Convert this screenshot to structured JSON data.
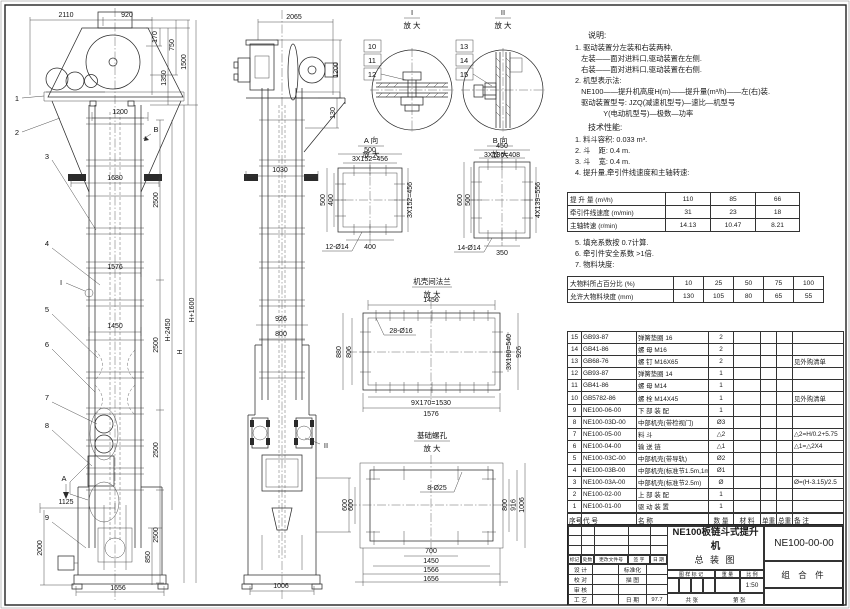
{
  "sheet": {
    "product": "NE100板链斗式提升机",
    "sheet_name": "总  装  图",
    "drawing_no": "NE100-00-00",
    "part_type": "组 合 件",
    "scale": "1:50",
    "date": "97.7"
  },
  "notes": {
    "title": "说明:",
    "lines": [
      "1. 驱动装置分左装和右装两种,",
      "   左装——面对进料口,驱动装置在左侧.",
      "   右装——面对进料口,驱动装置在右侧.",
      "2. 机型表示法:",
      "   NE100——提升机高度H(m)——提升量(m³/h)——左(右)装.",
      "   驱动装置型号: JZQ(减速机型号)—速比—机型号",
      "              Y(电动机型号)—极数—功率"
    ]
  },
  "tech": {
    "title": "技术性能:",
    "lines": [
      "1. 料斗容积: 0.033 m³.",
      "2. 斗    距: 0.4 m.",
      "3. 斗    宽: 0.4 m.",
      "4. 提升量,牵引件线速度和主轴转速:"
    ],
    "lines2": [
      "5. 填充系数按 0.7计算.",
      "6. 牵引件安全系数 >1倍.",
      "7. 物料块度:"
    ]
  },
  "spec_table": {
    "rows": [
      [
        "提 升 量  (m³/h)",
        "110",
        "85",
        "66"
      ],
      [
        "牵引件线速度 (m/min)",
        "31",
        "23",
        "18"
      ],
      [
        "主轴转速 (r/min)",
        "14.13",
        "10.47",
        "8.21"
      ]
    ]
  },
  "lump_table": {
    "rows": [
      [
        "大物料所占百分比 (%)",
        "10",
        "25",
        "50",
        "75",
        "100"
      ],
      [
        "允许大物料块度 (mm)",
        "130",
        "105",
        "80",
        "65",
        "55"
      ]
    ]
  },
  "bom": {
    "header_rows": [
      [
        "序号",
        "代  号",
        "名    称",
        "数 量",
        "材  料",
        "单重",
        "总重",
        "备  注"
      ]
    ],
    "rows": [
      [
        "15",
        "GB93-87",
        "弹簧垫圈 16",
        "2",
        "",
        "",
        "",
        ""
      ],
      [
        "14",
        "GB41-86",
        "螺  母  M16",
        "2",
        "",
        "",
        "",
        ""
      ],
      [
        "13",
        "GB68-76",
        "螺  钉  M16X65",
        "2",
        "",
        "",
        "",
        "见外购清单"
      ],
      [
        "12",
        "GB93-87",
        "弹簧垫圈 14",
        "1",
        "",
        "",
        "",
        ""
      ],
      [
        "11",
        "GB41-86",
        "螺  母  M14",
        "1",
        "",
        "",
        "",
        ""
      ],
      [
        "10",
        "GB5782-86",
        "螺  栓  M14X45",
        "1",
        "",
        "",
        "",
        "见外购清单"
      ],
      [
        "9",
        "NE100-06-00",
        "下 部 装 配",
        "1",
        "",
        "",
        "",
        ""
      ],
      [
        "8",
        "NE100-03D-00",
        "中部机壳(带检视门)",
        "Ø3",
        "",
        "",
        "",
        ""
      ],
      [
        "7",
        "NE100-05-00",
        "料  斗",
        "△2",
        "",
        "",
        "",
        "△2=H/0.2+5.75"
      ],
      [
        "6",
        "NE100-04-00",
        "输 送 链",
        "△1",
        "",
        "",
        "",
        "△1=△2X4"
      ],
      [
        "5",
        "NE100-03C-00",
        "中部机壳(带导轨)",
        "Ø2",
        "",
        "",
        "",
        ""
      ],
      [
        "4",
        "NE100-03B-00",
        "中部机壳(标准节1.5m,1m)",
        "Ø1",
        "",
        "",
        "",
        ""
      ],
      [
        "3",
        "NE100-03A-00",
        "中部机壳(标准节2.5m)",
        "Ø",
        "",
        "",
        "",
        "Ø=(H-3.15)/2.5"
      ],
      [
        "2",
        "NE100-02-00",
        "上 部 装 配",
        "1",
        "",
        "",
        "",
        ""
      ],
      [
        "1",
        "NE100-01-00",
        "驱 动 装 置",
        "1",
        "",
        "",
        "",
        ""
      ]
    ]
  },
  "title_block": {
    "rev_empty": [
      [
        "",
        "",
        "",
        "",
        ""
      ],
      [
        "",
        "",
        "",
        "",
        ""
      ],
      [
        "",
        "",
        "",
        "",
        ""
      ]
    ],
    "rev_header": [
      "标记",
      "处数",
      "更改文件号",
      "签 字",
      "日 期"
    ],
    "left_rows": [
      [
        "设 计",
        "",
        "标准化",
        ""
      ],
      [
        "校 对",
        "",
        "描 图",
        ""
      ],
      [
        "审 核",
        "",
        "",
        ""
      ],
      [
        "工 艺",
        "",
        "日 期",
        "97.7"
      ]
    ],
    "mark_label": "图 样 标 记",
    "weight_label": "重 量",
    "scale_label": "比 例",
    "sheets_label": "共    张",
    "page_label": "第    张"
  },
  "labels": {
    "n1": "1",
    "n2": "2",
    "n3": "3",
    "n4": "4",
    "n5": "5",
    "n6": "6",
    "n7": "7",
    "n8": "8",
    "n9": "9",
    "n10": "10",
    "n11": "11",
    "n12": "12",
    "n13": "13",
    "n14": "14",
    "n15": "15",
    "mA": "A",
    "mB": "B",
    "mI": "I",
    "mII": "II",
    "enlarge": "放 大",
    "dI": "I",
    "dII": "II",
    "dAv": "A 向",
    "dBv": "B 向",
    "flangeTitle": "机壳间法兰",
    "baseTitle": "基础螺孔",
    "d2110": "2110",
    "d920": "920",
    "d170": "170",
    "d750": "750",
    "d1350": "1350",
    "d1500": "1500",
    "d1200": "1200",
    "d1680": "1680",
    "d1576": "1576",
    "d1450": "1450",
    "d2500": "2500",
    "dH2450": "H-2450",
    "dH": "H",
    "dH1600": "H+1600",
    "d1125": "1125",
    "d2000": "2000",
    "d850": "850",
    "d1656": "1656",
    "d2065": "2065",
    "d1200b": "1200",
    "d130": "130",
    "d1030": "1030",
    "d926": "926",
    "d800": "800",
    "d1006": "1006",
    "d600": "600",
    "a500": "500",
    "a3x152": "3X152=456",
    "a400": "400",
    "a12d14": "12-Ø14",
    "b450": "450",
    "b3x136": "3X136=408",
    "b600": "600",
    "b500": "500",
    "b4x139": "4X139=556",
    "b350": "350",
    "b14d14": "14-Ø14",
    "f1456": "1456",
    "f28d16": "28-Ø16",
    "f880": "880",
    "f806": "806",
    "f3x180": "3X180=540",
    "f926": "926",
    "f9x170": "9X170=1530",
    "f1576": "1576",
    "g8d25": "8-Ø25",
    "g600": "600",
    "g800": "800",
    "g916": "916",
    "g1006": "1006",
    "g700": "700",
    "g1450": "1450",
    "g1566": "1566",
    "g1656": "1656"
  }
}
